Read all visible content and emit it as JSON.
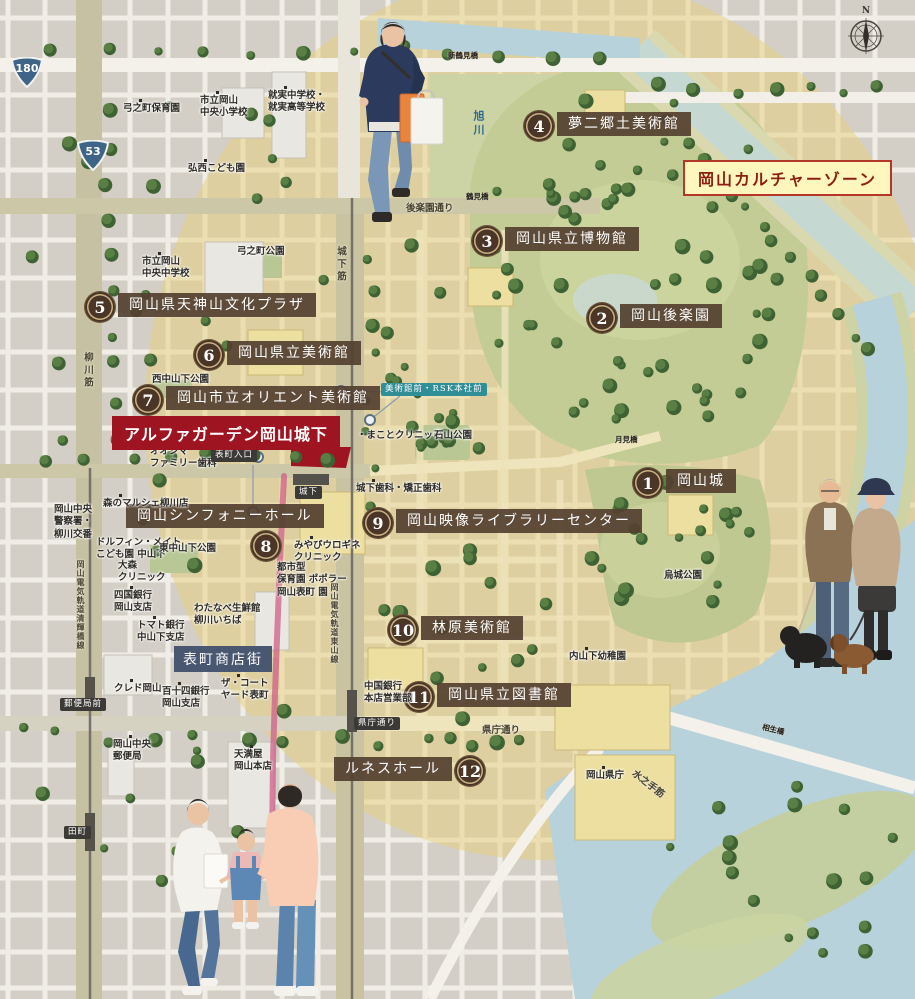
{
  "zone": {
    "label": "岡山カルチャーゾーン",
    "x": 683,
    "y": 160
  },
  "property": {
    "label": "アルファガーデン岡山城下",
    "x": 112,
    "y": 416
  },
  "shopping_street": {
    "label": "表町商店街",
    "x": 174,
    "y": 646
  },
  "compass": {
    "label": "N",
    "x": 845,
    "y": 8
  },
  "colors": {
    "property_red": "#9e1420",
    "zone_yellow_bg": "#fdf7bd",
    "zone_border_red": "#b5372a",
    "badge_brown": "#4a3527",
    "label_brown": "#54412f",
    "street_navy": "#4a5770",
    "stop_dark": "#3b3a36",
    "stop_teal": "#2f8e96",
    "water_blue": "#b7d2da",
    "park_green": "#c2cc94",
    "culture_zone_fill": "#e8cf7a",
    "arcade_pink": "#cf5f88"
  },
  "route_shields": [
    {
      "number": "180",
      "x": 27,
      "y": 73
    },
    {
      "number": "53",
      "x": 93,
      "y": 156
    }
  ],
  "landmarks": [
    {
      "number": "1",
      "name": "岡山城",
      "bx": 648,
      "by": 483,
      "lx": 666,
      "ly": 469
    },
    {
      "number": "2",
      "name": "岡山後楽園",
      "bx": 602,
      "by": 318,
      "lx": 620,
      "ly": 304
    },
    {
      "number": "3",
      "name": "岡山県立博物館",
      "bx": 487,
      "by": 241,
      "lx": 505,
      "ly": 227
    },
    {
      "number": "4",
      "name": "夢二郷土美術館",
      "bx": 539,
      "by": 126,
      "lx": 557,
      "ly": 112
    },
    {
      "number": "5",
      "name": "岡山県天神山文化プラザ",
      "bx": 100,
      "by": 307,
      "lx": 118,
      "ly": 293
    },
    {
      "number": "6",
      "name": "岡山県立美術館",
      "bx": 209,
      "by": 355,
      "lx": 227,
      "ly": 341
    },
    {
      "number": "7",
      "name": "岡山市立オリエント美術館",
      "bx": 148,
      "by": 400,
      "lx": 166,
      "ly": 386
    },
    {
      "number": "8",
      "name": "岡山シンフォニーホール",
      "bx": 266,
      "by": 546,
      "lx": 126,
      "ly": 504
    },
    {
      "number": "9",
      "name": "岡山映像ライブラリーセンター",
      "bx": 378,
      "by": 523,
      "lx": 396,
      "ly": 509
    },
    {
      "number": "10",
      "name": "林原美術館",
      "bx": 403,
      "by": 630,
      "lx": 421,
      "ly": 616
    },
    {
      "number": "11",
      "name": "岡山県立図書館",
      "bx": 419,
      "by": 697,
      "lx": 437,
      "ly": 683
    },
    {
      "number": "12",
      "name": "ルネスホール",
      "bx": 470,
      "by": 771,
      "lx": 452,
      "ly": 757,
      "side": "left"
    }
  ],
  "facilities": [
    {
      "lines": [
        "弓之町保育園"
      ],
      "x": 123,
      "y": 103,
      "dot": true
    },
    {
      "lines": [
        "市立岡山",
        "中央小学校"
      ],
      "x": 200,
      "y": 95,
      "dot": true
    },
    {
      "lines": [
        "就実中学校・",
        "就実高等学校"
      ],
      "x": 268,
      "y": 90,
      "dot": true
    },
    {
      "lines": [
        "弘西こども園"
      ],
      "x": 188,
      "y": 163,
      "dot": true
    },
    {
      "lines": [
        "市立岡山",
        "中央中学校"
      ],
      "x": 142,
      "y": 256,
      "dot": true
    },
    {
      "lines": [
        "弓之町公園"
      ],
      "x": 237,
      "y": 246
    },
    {
      "lines": [
        "西中山下公園"
      ],
      "x": 152,
      "y": 374
    },
    {
      "lines": [
        "オオシマ",
        "ファミリー歯科"
      ],
      "x": 150,
      "y": 446,
      "dot": true
    },
    {
      "lines": [
        "・まことクリニック"
      ],
      "x": 357,
      "y": 430
    },
    {
      "lines": [
        "石山公園"
      ],
      "x": 434,
      "y": 430
    },
    {
      "lines": [
        "城下歯科・矯正歯科"
      ],
      "x": 356,
      "y": 483,
      "dot": true
    },
    {
      "lines": [
        "みやびウロギネ",
        "クリニック"
      ],
      "x": 294,
      "y": 540,
      "dot": true
    },
    {
      "lines": [
        "都市型",
        "保育園 ポポラー",
        "岡山表町 園"
      ],
      "x": 277,
      "y": 562
    },
    {
      "lines": [
        "森のマルシェ柳川店"
      ],
      "x": 103,
      "y": 498,
      "dot": true
    },
    {
      "lines": [
        "岡山中央",
        "警察署・",
        "柳川交番"
      ],
      "x": 54,
      "y": 504
    },
    {
      "lines": [
        "ドルフィン・メイト",
        "こども園 中山下"
      ],
      "x": 96,
      "y": 537
    },
    {
      "lines": [
        "東中山下公園"
      ],
      "x": 159,
      "y": 543
    },
    {
      "lines": [
        "大森",
        "クリニック"
      ],
      "x": 118,
      "y": 560
    },
    {
      "lines": [
        "四国銀行",
        "岡山支店"
      ],
      "x": 114,
      "y": 590,
      "dot": true
    },
    {
      "lines": [
        "わたなべ生鮮館",
        "柳川いちば"
      ],
      "x": 194,
      "y": 603
    },
    {
      "lines": [
        "トマト銀行",
        "中山下支店"
      ],
      "x": 137,
      "y": 620,
      "dot": true
    },
    {
      "lines": [
        "クレド岡山"
      ],
      "x": 114,
      "y": 683,
      "dot": true
    },
    {
      "lines": [
        "百十四銀行",
        "岡山支店"
      ],
      "x": 162,
      "y": 686,
      "dot": true
    },
    {
      "lines": [
        "ザ・コート",
        "ヤード表町"
      ],
      "x": 221,
      "y": 678,
      "dot": true
    },
    {
      "lines": [
        "岡山中央",
        "郵便局"
      ],
      "x": 113,
      "y": 739,
      "dot": true
    },
    {
      "lines": [
        "天満屋",
        "岡山本店"
      ],
      "x": 234,
      "y": 749,
      "dot": true
    },
    {
      "lines": [
        "中国銀行",
        "本店営業部"
      ],
      "x": 364,
      "y": 681
    },
    {
      "lines": [
        "内山下幼稚園"
      ],
      "x": 569,
      "y": 651,
      "dot": true
    },
    {
      "lines": [
        "烏城公園"
      ],
      "x": 664,
      "y": 570
    },
    {
      "lines": [
        "岡山県庁"
      ],
      "x": 586,
      "y": 770,
      "dot": true
    }
  ],
  "tram_stops": [
    {
      "label": "表町入口",
      "x": 211,
      "y": 449,
      "variant": "dark"
    },
    {
      "label": "城下",
      "x": 295,
      "y": 486,
      "variant": "dark"
    },
    {
      "label": "美術館前・RSK本社前",
      "x": 381,
      "y": 383,
      "variant": "teal"
    },
    {
      "label": "郵便局前",
      "x": 60,
      "y": 698,
      "variant": "dark"
    },
    {
      "label": "田町",
      "x": 64,
      "y": 826,
      "variant": "dark"
    },
    {
      "label": "県庁通り",
      "x": 354,
      "y": 717,
      "variant": "dark"
    }
  ],
  "road_labels": [
    {
      "label": "後楽園通り",
      "x": 406,
      "y": 200
    },
    {
      "label": "県庁通り",
      "x": 482,
      "y": 722
    },
    {
      "label": "水之手筋",
      "x": 630,
      "y": 776,
      "angle": 38
    },
    {
      "label": "柳川筋",
      "x": 80,
      "y": 352,
      "vertical": true
    },
    {
      "label": "城下筋",
      "x": 333,
      "y": 246,
      "vertical": true
    },
    {
      "label": "岡山電気軌道清輝橋線",
      "x": 76,
      "y": 560,
      "vertical": true,
      "tiny": true
    },
    {
      "label": "岡山電気軌道東山線",
      "x": 330,
      "y": 583,
      "vertical": true,
      "tiny": true
    }
  ],
  "bridges": [
    {
      "label": "新鶴見橋",
      "x": 448,
      "y": 50
    },
    {
      "label": "鶴見橋",
      "x": 466,
      "y": 191
    },
    {
      "label": "月見橋",
      "x": 615,
      "y": 434
    },
    {
      "label": "相生橋",
      "x": 762,
      "y": 724,
      "angle": 14
    }
  ],
  "river": {
    "label": "旭川",
    "x": 470,
    "y": 110
  }
}
